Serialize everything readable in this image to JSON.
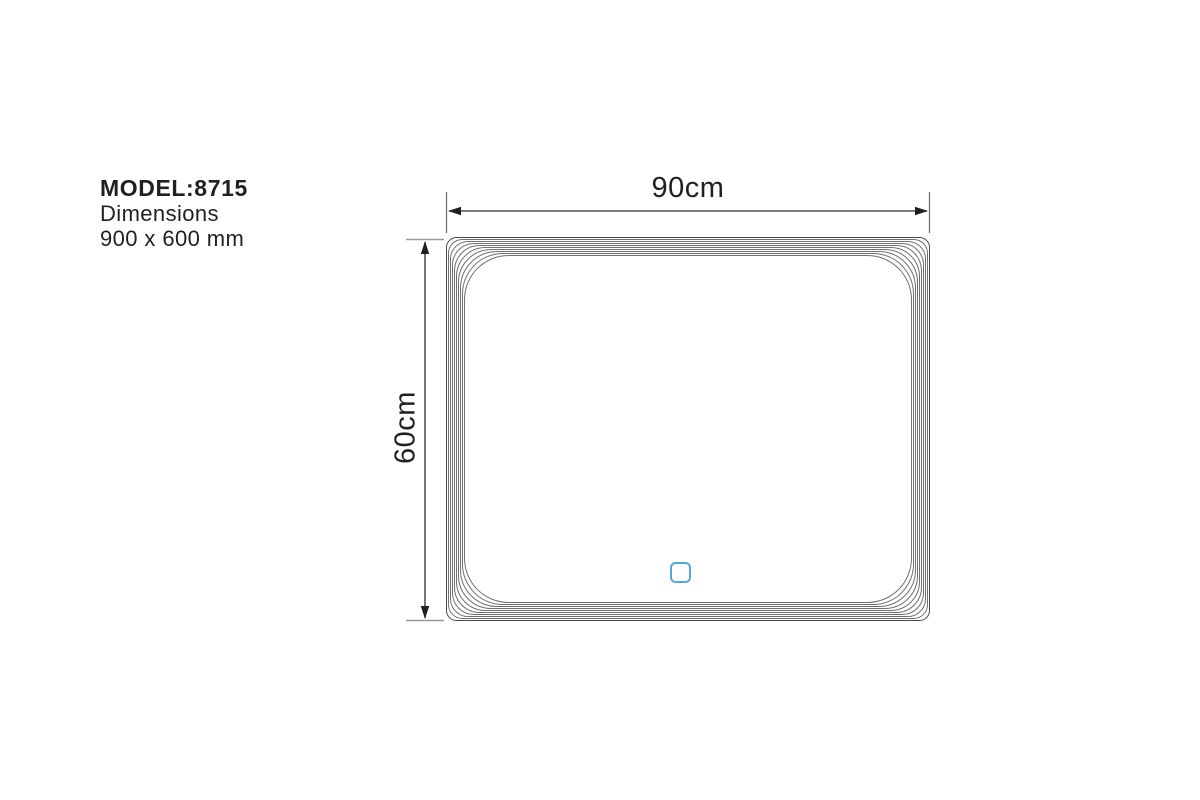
{
  "product": {
    "model_label": "MODEL:8715",
    "dimensions_label": "Dimensions",
    "dimensions_value": "900 x 600 mm"
  },
  "diagram": {
    "width_label": "90cm",
    "height_label": "60cm",
    "touch_sensor_icon": "touch-sensor-square"
  },
  "colors": {
    "background": "#ffffff",
    "text": "#231f20",
    "frame-line": "#6f6f6f",
    "frame-line-outer": "#4a4a4a",
    "dimension-line": "#2f2f2f",
    "arrow": "#1f1f1f",
    "extension-line": "#6b6b6b",
    "cap-line": "#9a9a9a",
    "accent-blue": "#58a7da"
  }
}
